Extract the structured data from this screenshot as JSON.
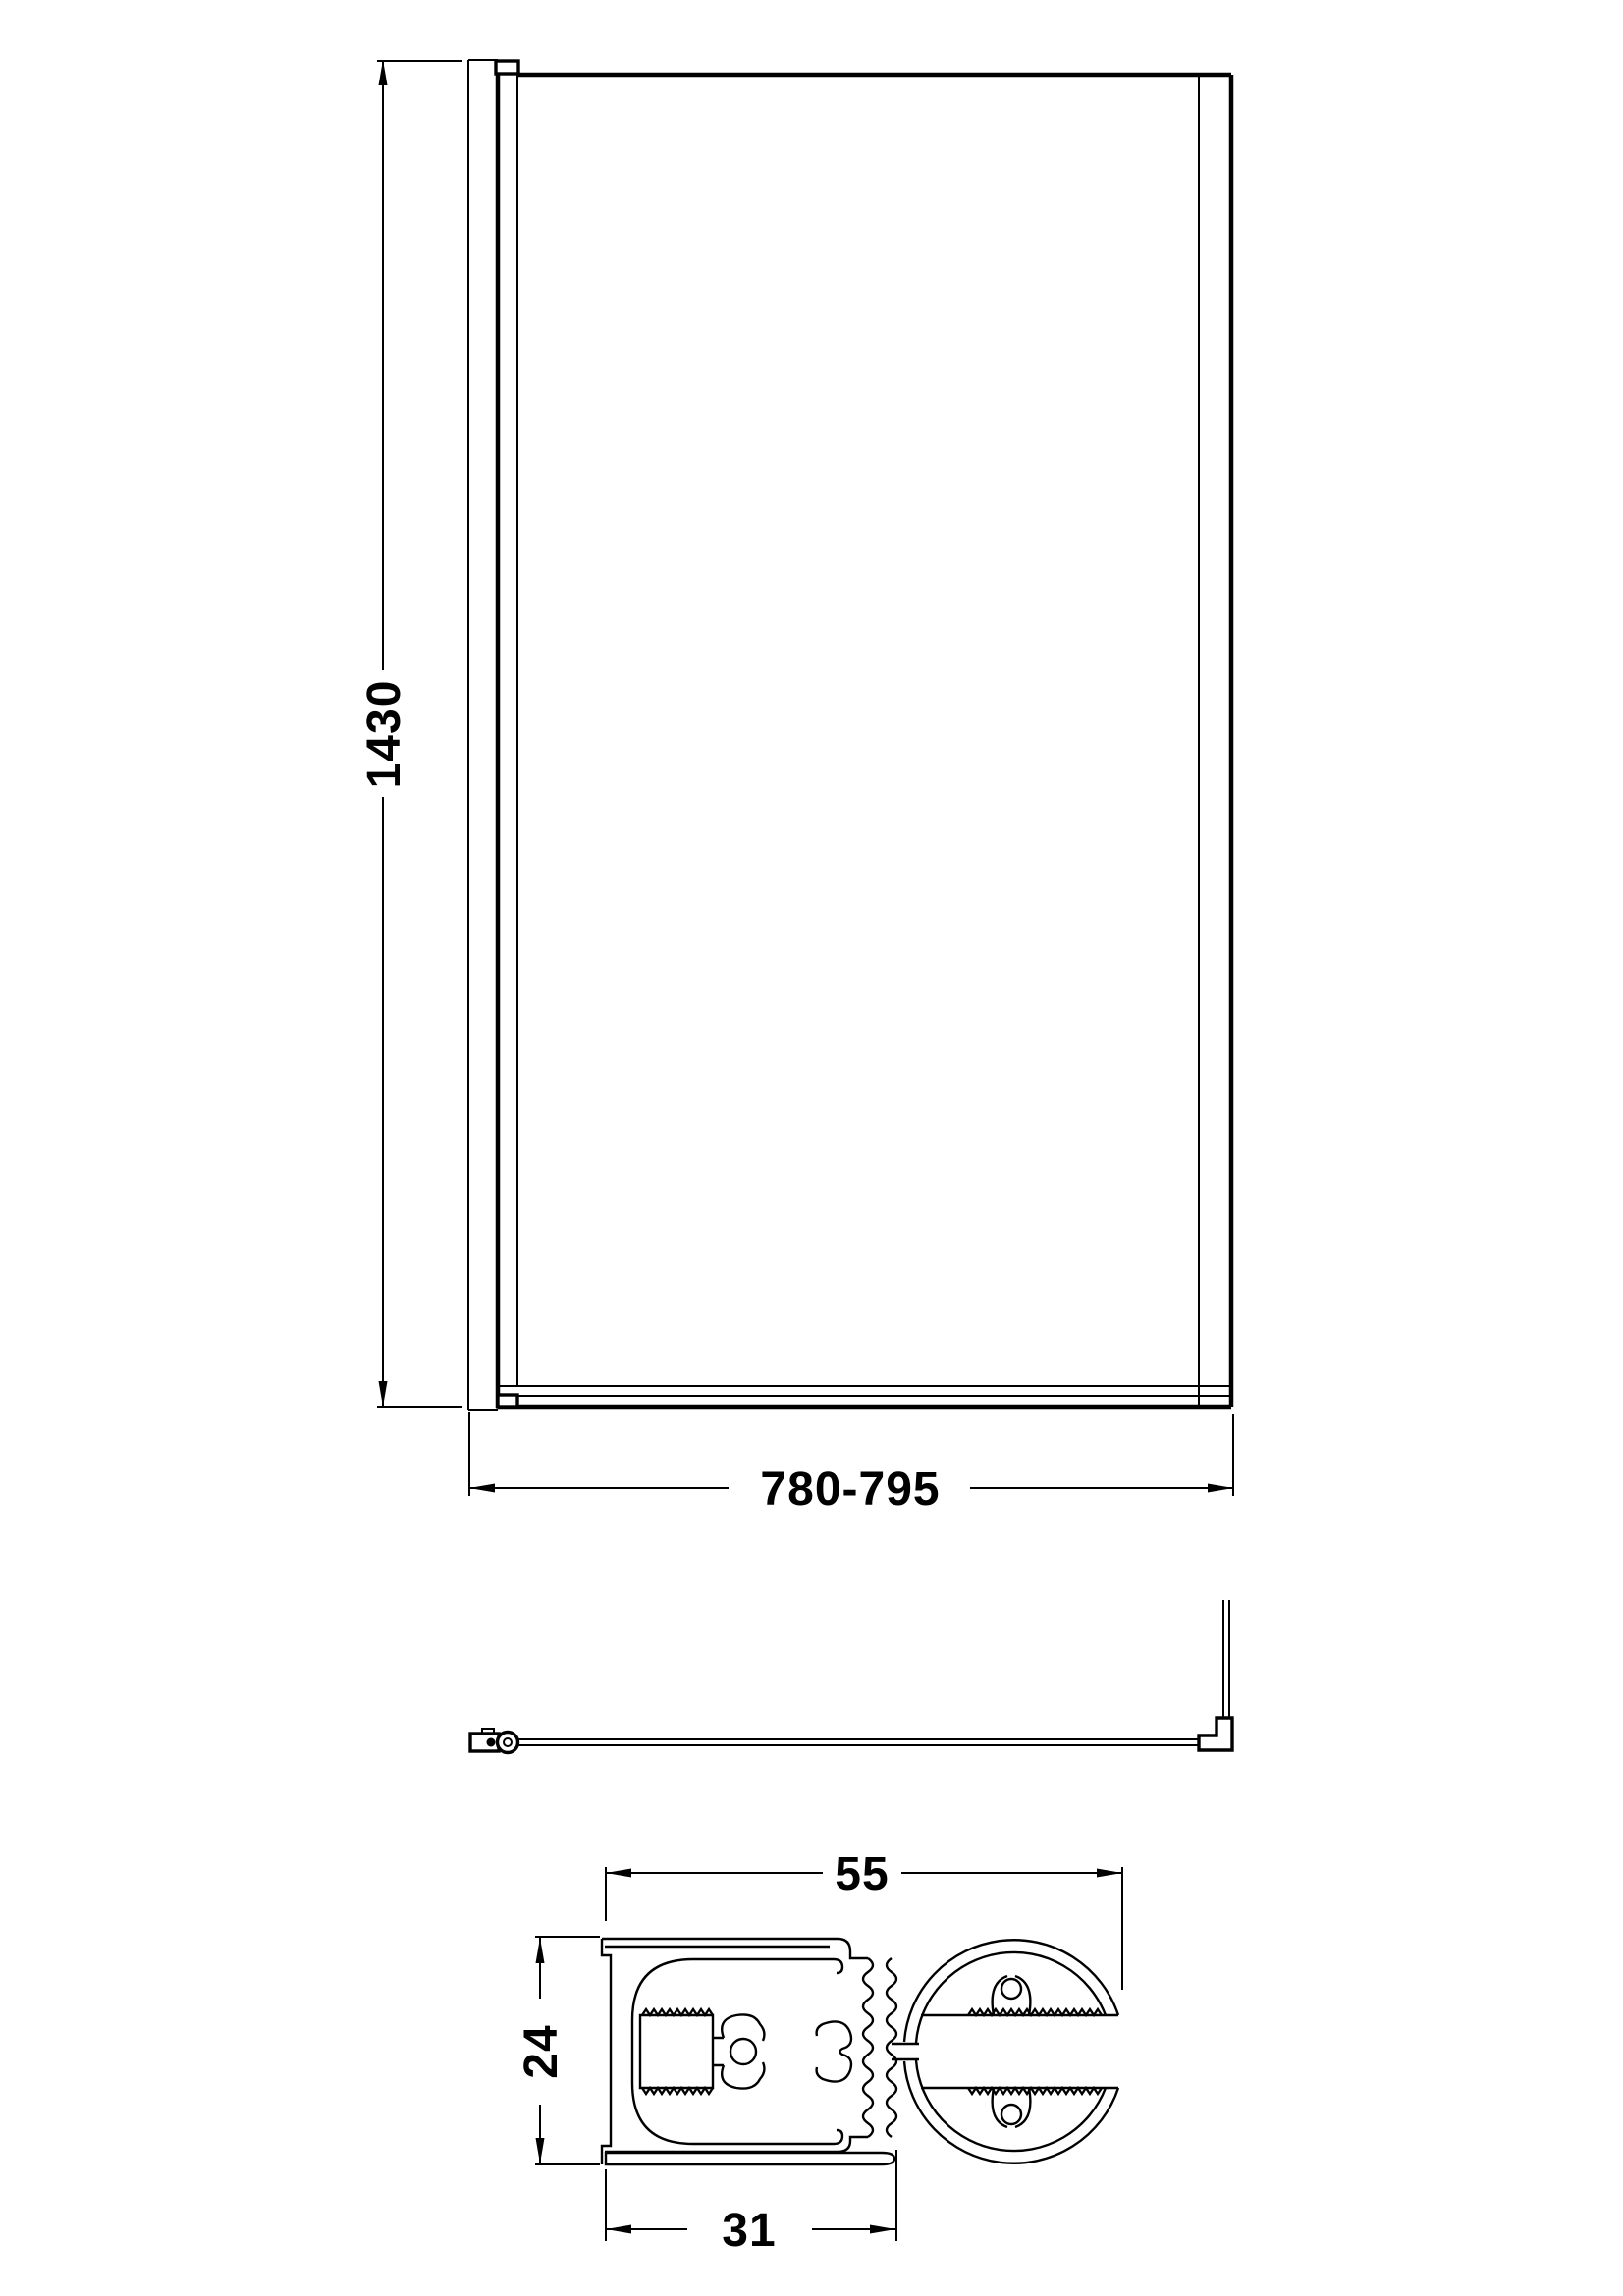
{
  "page": {
    "background": "#ffffff",
    "line_color": "#000000"
  },
  "views": {
    "front": "front-view",
    "plan": "plan-view",
    "section": "section-view"
  },
  "dimensions": {
    "height": "1430",
    "width_range": "780-795",
    "section_overall_width": "55",
    "section_depth": "24",
    "section_channel_width": "31"
  }
}
